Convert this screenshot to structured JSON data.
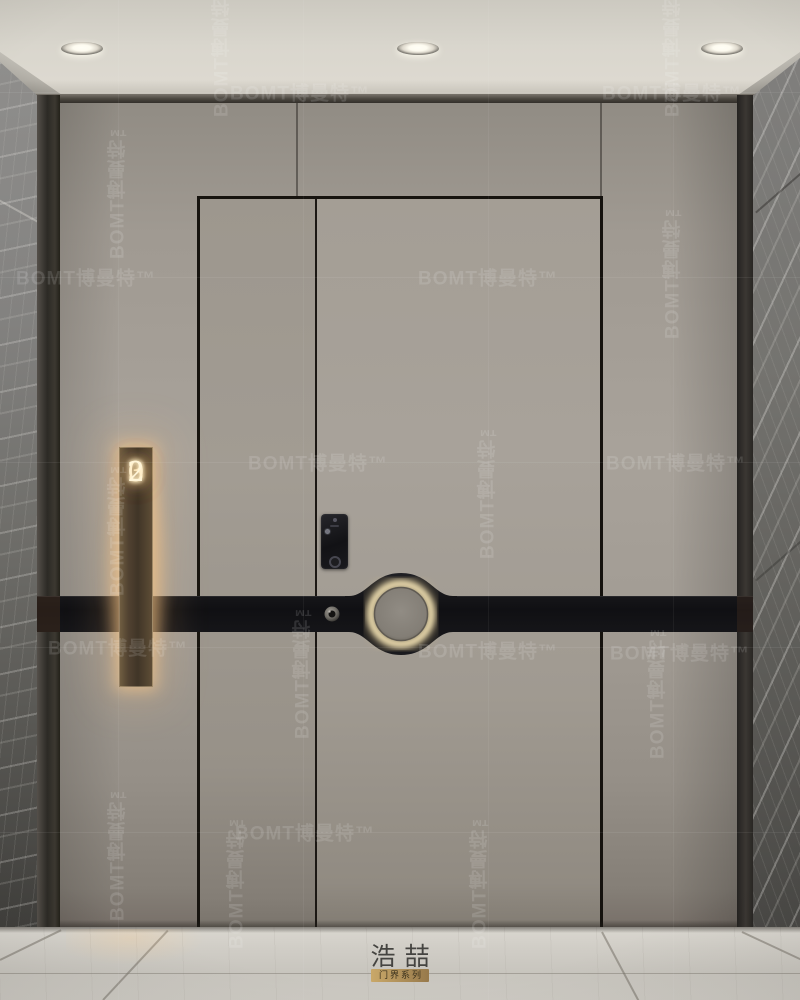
{
  "brand": {
    "watermark_text": "BOMT博曼特™"
  },
  "door": {
    "number": "302"
  },
  "logo": {
    "name": "浩喆",
    "series_label": "门界系列"
  },
  "colors": {
    "ceiling": "#d9d6cd",
    "wall": "#a8a29a",
    "door": "#a49e95",
    "marble": "#6f6e6a",
    "band": "#131316",
    "plaque_glow": "#ffcc8a",
    "plaque_bronze": "#51422f",
    "floor": "#cdcac3",
    "logo_gold": "#c9a869"
  },
  "ceiling": {
    "lights_x": [
      82,
      418,
      722
    ]
  },
  "lock": {
    "keypad_rows": 4,
    "keypad_cols": 3
  },
  "watermark": {
    "rows_y": [
      92,
      277,
      462,
      647,
      832
    ],
    "cols_x": [
      118,
      303,
      488,
      673
    ],
    "instances": [
      {
        "x": 300,
        "y": 92,
        "dir": "h"
      },
      {
        "x": 672,
        "y": 92,
        "dir": "h"
      },
      {
        "x": 86,
        "y": 277,
        "dir": "h"
      },
      {
        "x": 488,
        "y": 277,
        "dir": "h"
      },
      {
        "x": 318,
        "y": 462,
        "dir": "h"
      },
      {
        "x": 676,
        "y": 462,
        "dir": "h"
      },
      {
        "x": 118,
        "y": 647,
        "dir": "h"
      },
      {
        "x": 488,
        "y": 650,
        "dir": "h"
      },
      {
        "x": 680,
        "y": 652,
        "dir": "h"
      },
      {
        "x": 305,
        "y": 832,
        "dir": "h"
      },
      {
        "x": 222,
        "y": 46,
        "dir": "v"
      },
      {
        "x": 673,
        "y": 46,
        "dir": "v"
      },
      {
        "x": 118,
        "y": 188,
        "dir": "v"
      },
      {
        "x": 673,
        "y": 268,
        "dir": "v"
      },
      {
        "x": 488,
        "y": 488,
        "dir": "v"
      },
      {
        "x": 118,
        "y": 525,
        "dir": "v"
      },
      {
        "x": 303,
        "y": 668,
        "dir": "v"
      },
      {
        "x": 658,
        "y": 688,
        "dir": "v"
      },
      {
        "x": 118,
        "y": 850,
        "dir": "v"
      },
      {
        "x": 237,
        "y": 878,
        "dir": "v"
      },
      {
        "x": 480,
        "y": 878,
        "dir": "v"
      }
    ]
  }
}
